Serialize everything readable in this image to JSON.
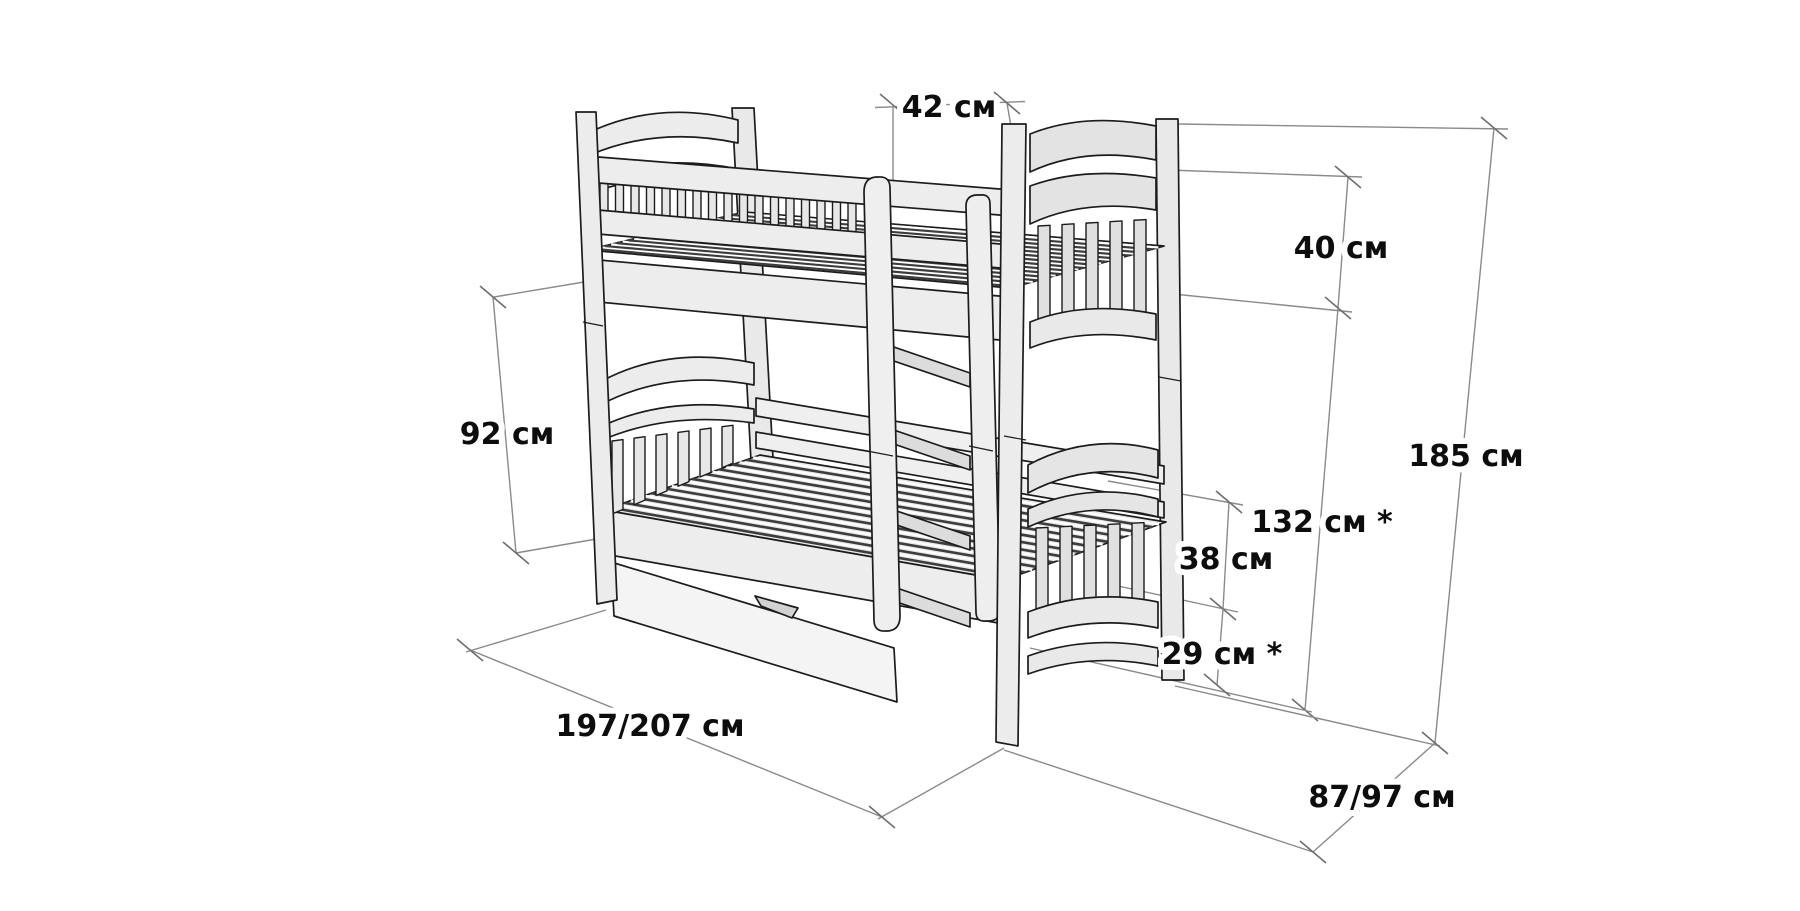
{
  "figure": {
    "type": "technical-dimension-diagram",
    "subject": "wooden bunk bed with slatted bases, ladder and under-bed storage drawer",
    "units_label": "см"
  },
  "dimensions": {
    "ladder_width": "42 см",
    "headboard_top_section": "40 см",
    "total_height": "185 см",
    "upper_rail_height": "132 см *",
    "lower_rail_section": "38 см",
    "under_bed_clearance": "29 см *",
    "lower_section_height": "92 см",
    "bed_length": "197/207 см",
    "bed_width": "87/97 см"
  },
  "colors": {
    "background": "#ffffff",
    "outline": "#1c1c1c",
    "wood_fill_light": "#ececec",
    "wood_fill_mid": "#e3e3e3",
    "slat_dark": "#3d3d3d",
    "dimension_line": "#8a8a8a",
    "label_text": "#0d0d0d"
  }
}
